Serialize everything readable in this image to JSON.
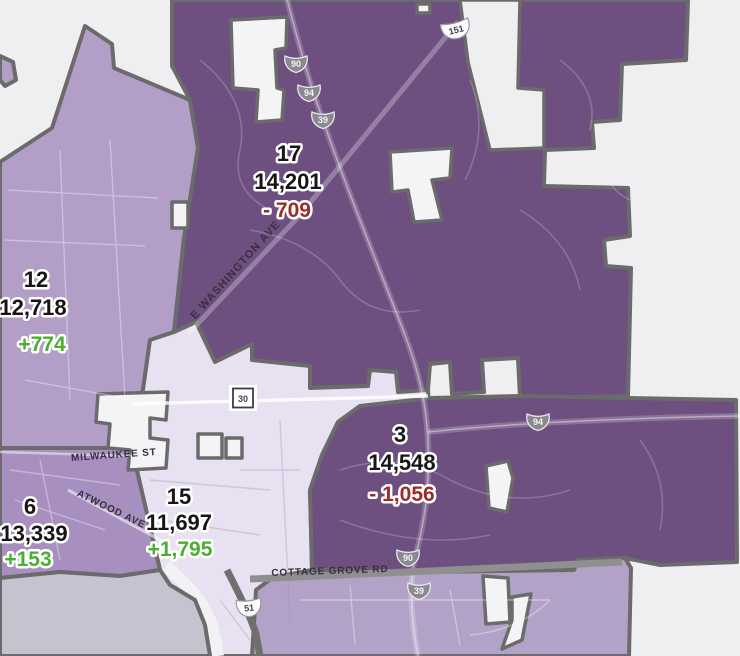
{
  "colors": {
    "background": "#efeef0",
    "district_dark_purple": "#6d4f80",
    "district_light_purple": "#b29ec7",
    "district_medium_purple": "#a78fbf",
    "district_pale_purple": "#e8e1f1",
    "district_southeast_purple": "#b3a2c8",
    "water": "#c6c3d1",
    "boundary": "#6b6b6b",
    "positive_change": "#4aae2f",
    "negative_change": "#9e2b25"
  },
  "districts": {
    "d17": {
      "number": "17",
      "population": "14,201",
      "change": "- 709"
    },
    "d12": {
      "number": "12",
      "population": "12,718",
      "change": "+774"
    },
    "d3": {
      "number": "3",
      "population": "14,548",
      "change": "- 1,056"
    },
    "d15": {
      "number": "15",
      "population": "11,697",
      "change": "+1,795"
    },
    "d6": {
      "number": "6",
      "population": "13,339",
      "change": "+153"
    }
  },
  "streets": {
    "e_washington": "E WASHINGTON AVE",
    "milwaukee": "MILWAUKEE ST",
    "atwood": "ATWOOD AVE",
    "cottage_grove": "COTTAGE GROVE RD"
  },
  "shields": {
    "i90_top": "90",
    "i94_top": "94",
    "i39_top": "39",
    "us151": "151",
    "hwy30": "30",
    "i94_east": "94",
    "i90_south": "90",
    "i39_south": "39",
    "us51": "51"
  }
}
